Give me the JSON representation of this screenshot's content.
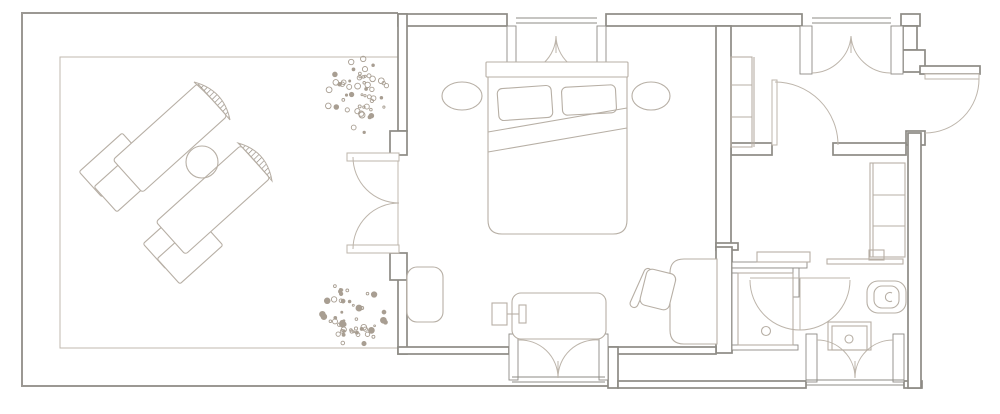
{
  "canvas": {
    "width": 1000,
    "height": 414,
    "background": "#ffffff"
  },
  "figure": {
    "kind": "architectural-floor-plan",
    "text_labels": []
  },
  "palette": {
    "wall_line": "#8d8b85",
    "furniture_line": "#b7afa5",
    "curtain_line": "#bdb5ab",
    "terrace_line": "#9b9893",
    "deck_line": "#c1b9af",
    "plant_dot": "#a89e92",
    "hatch_line": "#90877d",
    "background": "#ffffff"
  },
  "strokes": {
    "wall": 1.7,
    "furniture": 1.1,
    "curtain": 1.0,
    "thin": 0.9
  },
  "plants": [
    {
      "cx": 358,
      "cy": 96,
      "rx": 31,
      "ry": 34,
      "count": 52,
      "seed": 7
    },
    {
      "cx": 356,
      "cy": 314,
      "rx": 32,
      "ry": 31,
      "count": 52,
      "seed": 13
    }
  ]
}
